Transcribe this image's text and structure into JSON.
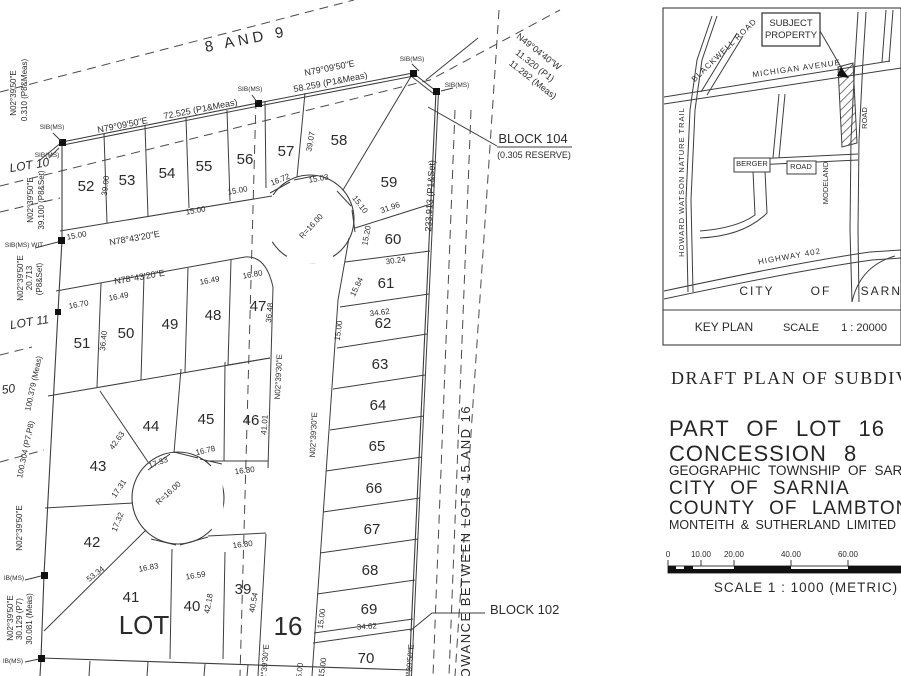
{
  "plan": {
    "labels": [
      {
        "t": "8  AND  9",
        "x": 247,
        "y": 44,
        "r": -11,
        "s": 15,
        "ls": 4,
        "n": "allowance-8-9-label"
      },
      {
        "t": "N02°39'50\"E",
        "x": 16,
        "y": 93,
        "r": -90
      },
      {
        "t": "0.310 (P8&Meas)",
        "x": 27,
        "y": 90,
        "r": -90
      },
      {
        "t": "SIB(MS)",
        "x": 52,
        "y": 129,
        "s": 6.5,
        "n": "monument-label"
      },
      {
        "t": "SIB(MS)",
        "x": 47,
        "y": 157,
        "s": 6.5,
        "n": "monument-label"
      },
      {
        "t": "LOT 10",
        "x": 30,
        "y": 169,
        "r": -9,
        "s": 12,
        "i": 1,
        "n": "lot-10-label"
      },
      {
        "t": "N02°39'50\"E",
        "x": 33,
        "y": 200,
        "r": -90
      },
      {
        "t": "39.100 (P8&Set)",
        "x": 44,
        "y": 200,
        "r": -90
      },
      {
        "t": "SIB(MS) WIT",
        "x": 24,
        "y": 247,
        "s": 6.5,
        "n": "monument-label"
      },
      {
        "t": "N02°39'50\"E",
        "x": 23,
        "y": 278,
        "r": -90
      },
      {
        "t": "20.713",
        "x": 32,
        "y": 278,
        "r": -90
      },
      {
        "t": "(P8&Set)",
        "x": 42,
        "y": 279,
        "r": -90
      },
      {
        "t": "LOT 11",
        "x": 30,
        "y": 326,
        "r": -9,
        "s": 12,
        "i": 1,
        "n": "lot-11-label"
      },
      {
        "t": "100.379 (Meas)",
        "x": 36,
        "y": 384,
        "r": -78
      },
      {
        "t": "100.304 (P7,P8)",
        "x": 28,
        "y": 450,
        "r": -78
      },
      {
        "t": "50",
        "x": 9,
        "y": 393,
        "r": -9,
        "s": 12,
        "i": 1,
        "n": "lot-50-label"
      },
      {
        "t": "N02°39'50\"E",
        "x": 22,
        "y": 528,
        "r": -90
      },
      {
        "t": "IB(MS)",
        "x": 14,
        "y": 580,
        "s": 6.5,
        "n": "monument-label"
      },
      {
        "t": "N02°39'50\"E",
        "x": 13,
        "y": 618,
        "r": -90
      },
      {
        "t": "30.129 (P7)",
        "x": 22,
        "y": 619,
        "r": -90
      },
      {
        "t": "30.081 (Meas)",
        "x": 32,
        "y": 619,
        "r": -90
      },
      {
        "t": "IB(MS)",
        "x": 13,
        "y": 663,
        "s": 6.5,
        "n": "monument-label"
      },
      {
        "t": "N79°09'50\"E",
        "x": 123,
        "y": 128,
        "r": -11,
        "s": 9
      },
      {
        "t": "72.525 (P1&Meas)",
        "x": 201,
        "y": 112,
        "r": -11,
        "s": 9
      },
      {
        "t": "SIB(MS)",
        "x": 250,
        "y": 91,
        "s": 6.5,
        "n": "monument-label"
      },
      {
        "t": "N79°09'50\"E",
        "x": 330,
        "y": 71,
        "r": -11,
        "s": 9
      },
      {
        "t": "58.259 (P1&Meas)",
        "x": 331,
        "y": 85,
        "r": -11,
        "s": 9
      },
      {
        "t": "SIB(MS)",
        "x": 412,
        "y": 61,
        "s": 6.5,
        "n": "monument-label"
      },
      {
        "t": "SIB(MS)",
        "x": 457,
        "y": 87,
        "s": 6.5,
        "n": "monument-label"
      },
      {
        "t": "N49°04'40\"W",
        "x": 537,
        "y": 54,
        "r": 38,
        "s": 9
      },
      {
        "t": "11.320 (P1)",
        "x": 533,
        "y": 68,
        "r": 38,
        "s": 9
      },
      {
        "t": "11.282 (Meas)",
        "x": 531,
        "y": 82,
        "r": 38,
        "s": 9
      },
      {
        "t": "BLOCK 104",
        "x": 533,
        "y": 143,
        "s": 13,
        "n": "block-104-label"
      },
      {
        "t": "(0.305 RESERVE)",
        "x": 534,
        "y": 158,
        "s": 9
      },
      {
        "t": "233.913 (P1&Set)",
        "x": 433,
        "y": 196,
        "r": -87,
        "s": 9
      },
      {
        "t": "52",
        "x": 86,
        "y": 191,
        "s": 15,
        "n": "lot-number"
      },
      {
        "t": "53",
        "x": 127,
        "y": 185,
        "s": 15,
        "n": "lot-number"
      },
      {
        "t": "54",
        "x": 167,
        "y": 178,
        "s": 15,
        "n": "lot-number"
      },
      {
        "t": "55",
        "x": 204,
        "y": 171,
        "s": 15,
        "n": "lot-number"
      },
      {
        "t": "56",
        "x": 245,
        "y": 164,
        "s": 15,
        "n": "lot-number"
      },
      {
        "t": "57",
        "x": 286,
        "y": 156,
        "s": 15,
        "n": "lot-number"
      },
      {
        "t": "58",
        "x": 339,
        "y": 145,
        "s": 15,
        "n": "lot-number"
      },
      {
        "t": "59",
        "x": 389,
        "y": 187,
        "s": 15,
        "n": "lot-number"
      },
      {
        "t": "60",
        "x": 393,
        "y": 244,
        "s": 15,
        "n": "lot-number"
      },
      {
        "t": "61",
        "x": 386,
        "y": 288,
        "s": 15,
        "n": "lot-number"
      },
      {
        "t": "62",
        "x": 383,
        "y": 328,
        "s": 15,
        "n": "lot-number"
      },
      {
        "t": "63",
        "x": 380,
        "y": 369,
        "s": 15,
        "n": "lot-number"
      },
      {
        "t": "64",
        "x": 378,
        "y": 410,
        "s": 15,
        "n": "lot-number"
      },
      {
        "t": "65",
        "x": 377,
        "y": 451,
        "s": 15,
        "n": "lot-number"
      },
      {
        "t": "66",
        "x": 374,
        "y": 493,
        "s": 15,
        "n": "lot-number"
      },
      {
        "t": "67",
        "x": 372,
        "y": 534,
        "s": 15,
        "n": "lot-number"
      },
      {
        "t": "68",
        "x": 370,
        "y": 575,
        "s": 15,
        "n": "lot-number"
      },
      {
        "t": "69",
        "x": 369,
        "y": 614,
        "s": 15,
        "n": "lot-number"
      },
      {
        "t": "70",
        "x": 366,
        "y": 663,
        "s": 15,
        "n": "lot-number"
      },
      {
        "t": "51",
        "x": 82,
        "y": 348,
        "s": 15,
        "n": "lot-number"
      },
      {
        "t": "50",
        "x": 126,
        "y": 338,
        "s": 15,
        "n": "lot-number"
      },
      {
        "t": "49",
        "x": 170,
        "y": 329,
        "s": 15,
        "n": "lot-number"
      },
      {
        "t": "48",
        "x": 213,
        "y": 320,
        "s": 15,
        "n": "lot-number"
      },
      {
        "t": "47",
        "x": 258,
        "y": 311,
        "s": 15,
        "n": "lot-number"
      },
      {
        "t": "46",
        "x": 251,
        "y": 425,
        "s": 15,
        "n": "lot-number"
      },
      {
        "t": "45",
        "x": 206,
        "y": 424,
        "s": 15,
        "n": "lot-number"
      },
      {
        "t": "44",
        "x": 151,
        "y": 431,
        "s": 15,
        "n": "lot-number"
      },
      {
        "t": "43",
        "x": 98,
        "y": 471,
        "s": 15,
        "n": "lot-number"
      },
      {
        "t": "42",
        "x": 92,
        "y": 547,
        "s": 15,
        "n": "lot-number"
      },
      {
        "t": "41",
        "x": 131,
        "y": 602,
        "s": 15,
        "n": "lot-number"
      },
      {
        "t": "40",
        "x": 192,
        "y": 611,
        "s": 15,
        "n": "lot-number"
      },
      {
        "t": "39",
        "x": 243,
        "y": 594,
        "s": 15,
        "n": "lot-number"
      },
      {
        "t": "39.00",
        "x": 108,
        "y": 186,
        "r": -83
      },
      {
        "t": "15.00",
        "x": 77,
        "y": 238,
        "r": -10
      },
      {
        "t": "N78°43'20\"E",
        "x": 135,
        "y": 241,
        "r": -10,
        "s": 9
      },
      {
        "t": "15.00",
        "x": 196,
        "y": 213,
        "r": -10
      },
      {
        "t": "15.00",
        "x": 238,
        "y": 193,
        "r": -10
      },
      {
        "t": "39.07",
        "x": 313,
        "y": 142,
        "r": -80
      },
      {
        "t": "16.72",
        "x": 281,
        "y": 182,
        "r": -22
      },
      {
        "t": "15.03",
        "x": 319,
        "y": 181,
        "r": -10
      },
      {
        "t": "15.10",
        "x": 358,
        "y": 206,
        "r": 52
      },
      {
        "t": "31.96",
        "x": 391,
        "y": 210,
        "r": -19
      },
      {
        "t": "15.20",
        "x": 369,
        "y": 236,
        "r": -80
      },
      {
        "t": "30.24",
        "x": 396,
        "y": 263,
        "r": -8
      },
      {
        "t": "15.84",
        "x": 359,
        "y": 288,
        "r": -64
      },
      {
        "t": "34.62",
        "x": 380,
        "y": 315,
        "r": -7
      },
      {
        "t": "15.00",
        "x": 341,
        "y": 331,
        "r": -82
      },
      {
        "t": "N78°43'20\"E",
        "x": 140,
        "y": 280,
        "r": -10,
        "s": 9
      },
      {
        "t": "16.70",
        "x": 79,
        "y": 307,
        "r": -10
      },
      {
        "t": "16.49",
        "x": 119,
        "y": 299,
        "r": -10
      },
      {
        "t": "16.49",
        "x": 210,
        "y": 283,
        "r": -10
      },
      {
        "t": "16.80",
        "x": 253,
        "y": 277,
        "r": -10
      },
      {
        "t": "36.40",
        "x": 106,
        "y": 341,
        "r": -84
      },
      {
        "t": "36.48",
        "x": 272,
        "y": 313,
        "r": -84
      },
      {
        "t": "N02°39'30\"E",
        "x": 281,
        "y": 377,
        "r": -87
      },
      {
        "t": "N02°39'30\"E",
        "x": 316,
        "y": 435,
        "r": -87
      },
      {
        "t": "41.01",
        "x": 267,
        "y": 425,
        "r": -86
      },
      {
        "t": "42.63",
        "x": 119,
        "y": 442,
        "r": -54
      },
      {
        "t": "17.33",
        "x": 159,
        "y": 465,
        "r": -20
      },
      {
        "t": "16.78",
        "x": 206,
        "y": 453,
        "r": -13
      },
      {
        "t": "16.80",
        "x": 245,
        "y": 473,
        "r": -7
      },
      {
        "t": "16.80",
        "x": 243,
        "y": 547,
        "r": -7
      },
      {
        "t": "17.31",
        "x": 121,
        "y": 490,
        "r": -56
      },
      {
        "t": "17.32",
        "x": 120,
        "y": 523,
        "r": -68
      },
      {
        "t": "R=16.00",
        "x": 313,
        "y": 228,
        "r": -47
      },
      {
        "t": "R=16.00",
        "x": 170,
        "y": 495,
        "r": -42
      },
      {
        "t": "53.34",
        "x": 97,
        "y": 576,
        "r": -38
      },
      {
        "t": "16.83",
        "x": 149,
        "y": 570,
        "r": -11
      },
      {
        "t": "16.59",
        "x": 196,
        "y": 578,
        "r": -9
      },
      {
        "t": "42.18",
        "x": 211,
        "y": 604,
        "r": -80
      },
      {
        "t": "40.54",
        "x": 256,
        "y": 603,
        "r": -80
      },
      {
        "t": "15.00",
        "x": 324,
        "y": 619,
        "r": -82
      },
      {
        "t": "34.62",
        "x": 367,
        "y": 629,
        "r": -4
      },
      {
        "t": "15.00",
        "x": 325,
        "y": 668,
        "r": -82
      },
      {
        "t": "15.00",
        "x": 302,
        "y": 673,
        "r": -84
      },
      {
        "t": "N02°39'30\"E",
        "x": 267,
        "y": 667,
        "r": -85
      },
      {
        "t": "N02°39'50\"E",
        "x": 412,
        "y": 667,
        "r": -85
      },
      {
        "t": "LOWANCE  BETWEEN  LOTS  15  AND  16",
        "x": 470,
        "y": 546,
        "r": -90,
        "s": 13,
        "ls": 1.5,
        "n": "road-allowance-15-16-label"
      },
      {
        "t": "BLOCK 102",
        "x": 490,
        "y": 614,
        "s": 13,
        "a": "start",
        "n": "block-102-label"
      },
      {
        "t": "LOT",
        "x": 144,
        "y": 634,
        "s": 26,
        "n": "lot-16-label-word"
      },
      {
        "t": "16",
        "x": 288,
        "y": 635,
        "s": 26,
        "n": "lot-16-label-number"
      }
    ]
  },
  "key_plan": {
    "labels": [
      {
        "t": "SUBJECT",
        "x": 791,
        "y": 26,
        "s": 9.5,
        "n": "subject-property-label"
      },
      {
        "t": "PROPERTY",
        "x": 791,
        "y": 38,
        "s": 9.5,
        "n": "subject-property-label"
      },
      {
        "t": "MICHIGAN  AVENUE",
        "x": 797,
        "y": 71,
        "r": -8,
        "s": 8,
        "ls": 1,
        "n": "road-label"
      },
      {
        "t": "BLACKWELL  ROAD",
        "x": 726,
        "y": 52,
        "r": -44,
        "s": 8,
        "ls": 1,
        "n": "road-label"
      },
      {
        "t": "HOWARD  WATSON  NATURE  TRAIL",
        "x": 684,
        "y": 182,
        "r": -90,
        "s": 7.5,
        "ls": 1,
        "n": "road-label"
      },
      {
        "t": "BERGER",
        "x": 752,
        "y": 166,
        "s": 7.5,
        "n": "road-label"
      },
      {
        "t": "ROAD",
        "x": 801,
        "y": 169,
        "s": 7.5,
        "n": "road-label"
      },
      {
        "t": "MODELAND",
        "x": 828,
        "y": 183,
        "r": -90,
        "s": 7.5,
        "n": "road-label"
      },
      {
        "t": "ROAD",
        "x": 867,
        "y": 118,
        "r": -90,
        "s": 7.5,
        "n": "road-label"
      },
      {
        "t": "HIGHWAY  402",
        "x": 790,
        "y": 259,
        "r": -10,
        "s": 8,
        "ls": 1,
        "n": "road-label"
      },
      {
        "t": "CITY",
        "x": 757,
        "y": 295,
        "s": 12,
        "ls": 2,
        "n": "city-label"
      },
      {
        "t": "OF",
        "x": 821,
        "y": 295,
        "s": 12,
        "ls": 2,
        "n": "city-label"
      },
      {
        "t": "SARNIA",
        "x": 889,
        "y": 295,
        "s": 12,
        "ls": 2,
        "n": "city-label"
      },
      {
        "t": "KEY PLAN",
        "x": 724,
        "y": 331,
        "s": 12,
        "f": "serif",
        "n": "key-plan-caption"
      },
      {
        "t": "SCALE",
        "x": 801,
        "y": 331,
        "s": 11,
        "n": "key-plan-scale"
      },
      {
        "t": "1 : 20000",
        "x": 864,
        "y": 331,
        "s": 11,
        "n": "key-plan-scale"
      }
    ]
  },
  "title_block": {
    "title": "DRAFT PLAN OF SUBDIVISION",
    "lines": [
      "PART OF LOT 16",
      "CONCESSION 8",
      "GEOGRAPHIC TOWNSHIP OF SARNIA",
      "CITY OF SARNIA",
      "COUNTY OF LAMBTON",
      "MONTEITH & SUTHERLAND LIMITED"
    ],
    "scale_bar": {
      "ticks": [
        "0",
        "10.00",
        "20.00",
        "40.00",
        "60.00"
      ],
      "caption": "SCALE   1 : 1000   (METRIC)"
    }
  }
}
